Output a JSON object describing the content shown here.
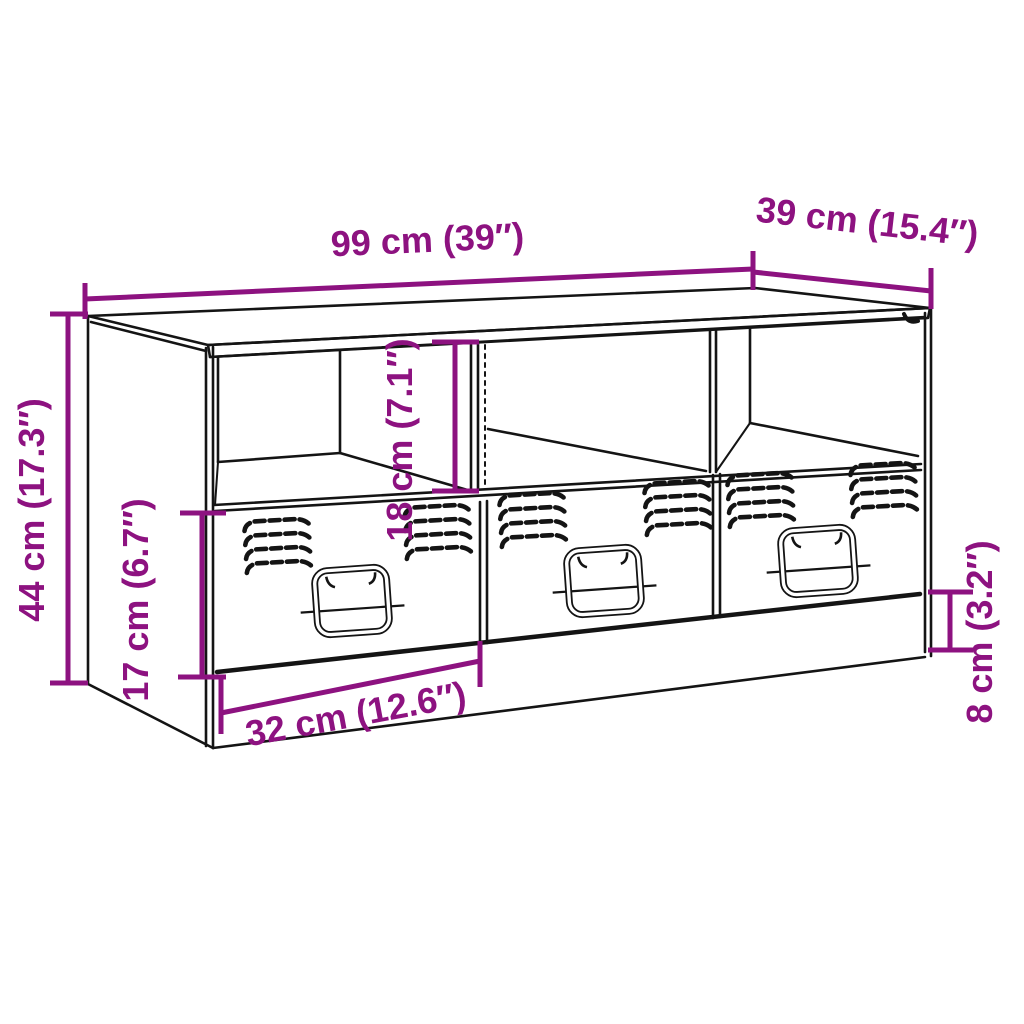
{
  "diagram": {
    "subject": "TV cabinet technical line drawing with three open compartments, three vented drawers with fold-down handles, and a recessed base",
    "style": "black outline drawing with purple dimension annotations on white background",
    "colors": {
      "line": "#141414",
      "accent": "#8D1280",
      "background": "#ffffff"
    },
    "dimensions": {
      "width": {
        "label": "99 cm (39″)",
        "cm": 99,
        "inch": 39
      },
      "depth": {
        "label": "39 cm (15.4″)",
        "cm": 39,
        "inch": 15.4
      },
      "height": {
        "label": "44 cm (17.3″)",
        "cm": 44,
        "inch": 17.3
      },
      "compartment_height": {
        "label": "18 cm (7.1″)",
        "cm": 18,
        "inch": 7.1
      },
      "drawer_height": {
        "label": "17 cm (6.7″)",
        "cm": 17,
        "inch": 6.7
      },
      "drawer_width": {
        "label": "32 cm (12.6″)",
        "cm": 32,
        "inch": 12.6
      },
      "base_height": {
        "label": "8 cm (3.2″)",
        "cm": 8,
        "inch": 3.2
      }
    }
  }
}
